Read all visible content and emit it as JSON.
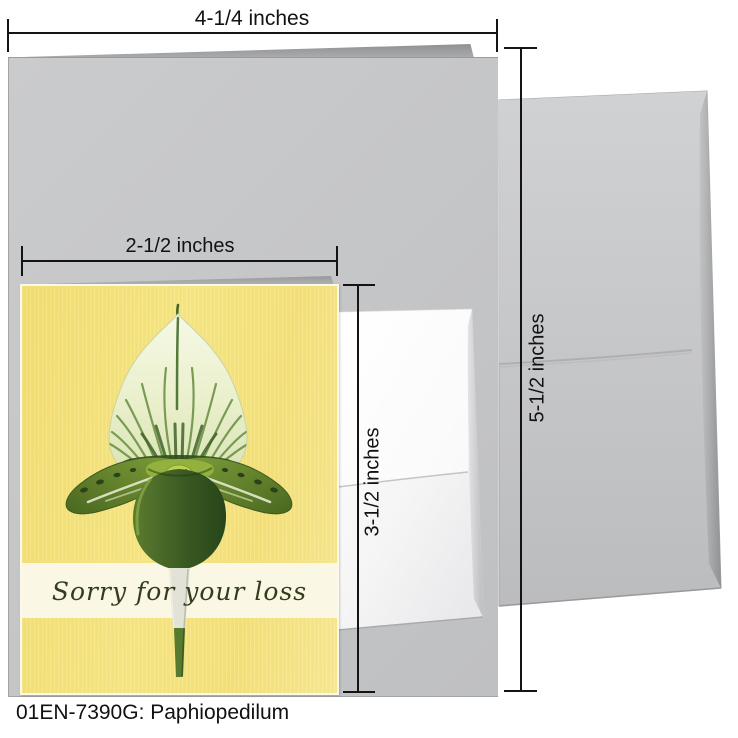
{
  "product": {
    "caption": "01EN-7390G: Paphiopedilum"
  },
  "annotations": {
    "card_open_width": "4-1/4 inches",
    "front_width": "2-1/2 inches",
    "front_height": "3-1/2 inches",
    "card_height": "5-1/2 inches"
  },
  "card": {
    "message": "Sorry for your loss"
  },
  "colors": {
    "card_yellow": "#f6e37c",
    "band_cream": "#fbf7e5",
    "pouch_green": "#3a5a22",
    "sepal_cream": "#eef1d4",
    "envelope_gray": "#c6c7c9",
    "annotation_black": "#141414"
  }
}
